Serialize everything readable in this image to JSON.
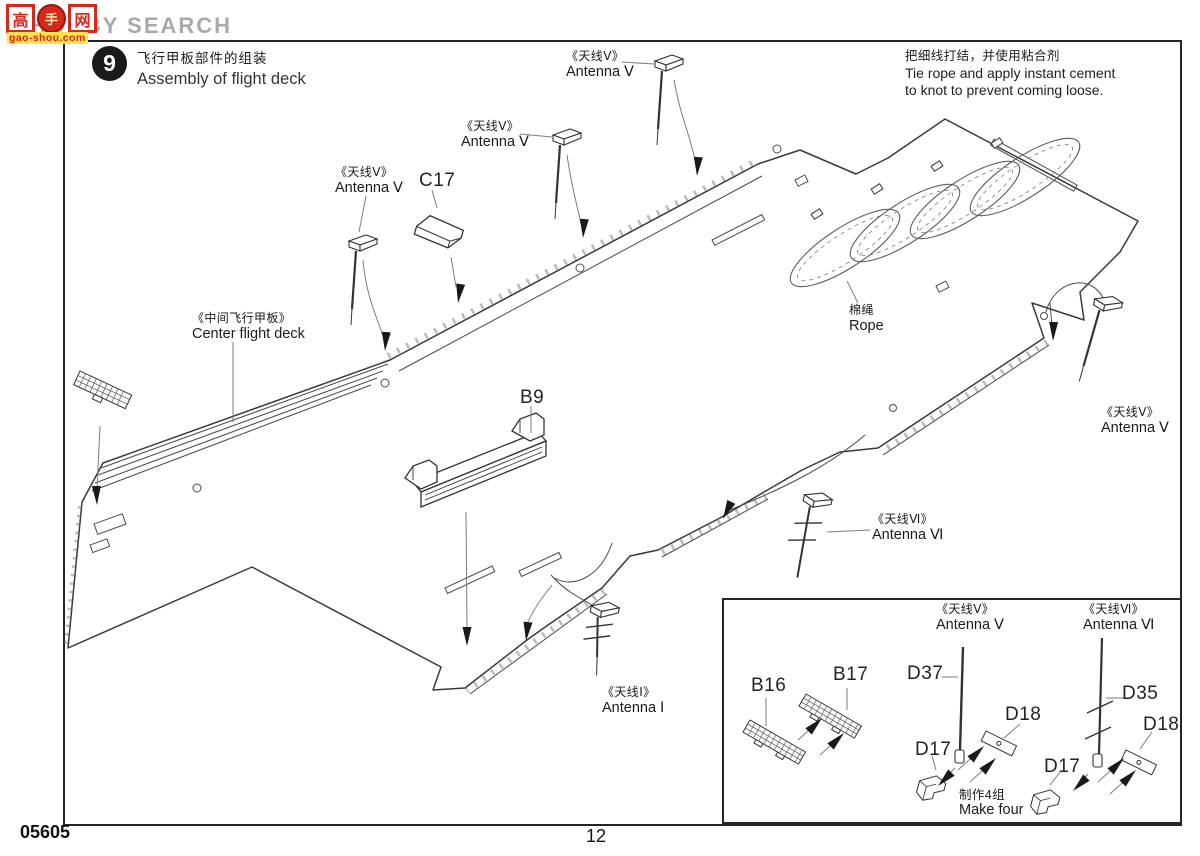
{
  "watermark": {
    "brand_text": "HOBBY SEARCH",
    "logo_char_1": "高",
    "logo_char_2": "手",
    "logo_char_3": "网",
    "logo_domain": "gao-shou.com"
  },
  "step": {
    "number": "9",
    "title_zh": "飞行甲板部件的组装",
    "title_en": "Assembly of flight deck"
  },
  "note": {
    "zh": "把细线打结，并使用粘合剂",
    "en_line1": "Tie rope and apply instant cement",
    "en_line2": "to knot to prevent coming loose."
  },
  "labels": {
    "antenna_v": {
      "zh": "《天线Ⅴ》",
      "en": "Antenna Ⅴ"
    },
    "antenna_vi": {
      "zh": "《天线Ⅵ》",
      "en": "Antenna Ⅵ"
    },
    "antenna_i": {
      "zh": "《天线Ⅰ》",
      "en": "Antenna Ⅰ"
    },
    "center_flight_deck": {
      "zh": "《中间飞行甲板》",
      "en": "Center flight deck"
    },
    "rope": {
      "zh": "棉绳",
      "en": "Rope"
    },
    "c17": "C17",
    "b9": "B9"
  },
  "inset": {
    "b16": "B16",
    "b17": "B17",
    "d37": "D37",
    "d17": "D17",
    "d18": "D18",
    "d35": "D35",
    "make": {
      "zh": "制作4组",
      "en": "Make four"
    }
  },
  "footer": {
    "kit_number": "05605",
    "page_number": "12"
  }
}
